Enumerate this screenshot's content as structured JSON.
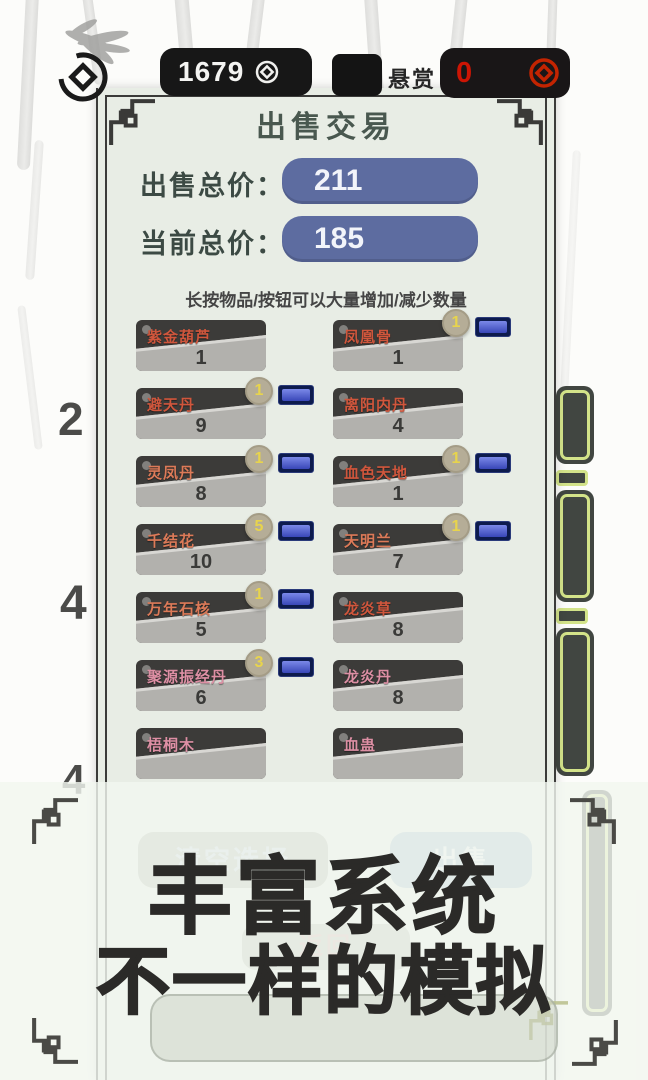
{
  "top_bar": {
    "coins": "1679",
    "bounty_label": "悬赏",
    "bounty_value": "0"
  },
  "dialog": {
    "title": "出售交易",
    "sell_total_label": "出售总价：",
    "sell_total_value": "211",
    "current_total_label": "当前总价：",
    "current_total_value": "185",
    "hint": "长按物品/按钮可以大量增加/减少数量",
    "items": [
      {
        "name": "紫金葫芦",
        "qty": "1",
        "badge": "",
        "color": "#d0563c"
      },
      {
        "name": "凤凰骨",
        "qty": "1",
        "badge": "1",
        "color": "#d0563c"
      },
      {
        "name": "避天丹",
        "qty": "9",
        "badge": "1",
        "color": "#d0563c"
      },
      {
        "name": "离阳内丹",
        "qty": "4",
        "badge": "",
        "color": "#d0563c"
      },
      {
        "name": "灵凤丹",
        "qty": "8",
        "badge": "1",
        "color": "#dc7a58"
      },
      {
        "name": "血色天地",
        "qty": "1",
        "badge": "1",
        "color": "#d0563c"
      },
      {
        "name": "千结花",
        "qty": "10",
        "badge": "5",
        "color": "#dc7a58"
      },
      {
        "name": "天明兰",
        "qty": "7",
        "badge": "1",
        "color": "#dc7a58"
      },
      {
        "name": "万年石核",
        "qty": "5",
        "badge": "1",
        "color": "#dc7a58"
      },
      {
        "name": "龙炎草",
        "qty": "8",
        "badge": "",
        "color": "#d0563c"
      },
      {
        "name": "聚源振经丹",
        "qty": "6",
        "badge": "3",
        "color": "#dd8fa4"
      },
      {
        "name": "龙炎丹",
        "qty": "8",
        "badge": "",
        "color": "#dd8fa4"
      },
      {
        "name": "梧桐木",
        "qty": "",
        "badge": "",
        "color": "#dd8fa4"
      },
      {
        "name": "血蛊",
        "qty": "",
        "badge": "",
        "color": "#dd8fa4"
      }
    ],
    "clear_button": "清空选择",
    "sell_button": "出售",
    "back_button": "返回"
  },
  "banner": {
    "line1": "丰富系统",
    "line2": "不一样的模拟"
  },
  "background": {
    "left_numbers": [
      "2",
      "4",
      "4"
    ]
  },
  "colors": {
    "dialog_bg": "#e8ede5",
    "price_pill": "#5d6ca0",
    "item_card_dark": "#3c3b39",
    "item_card_light": "#b2b1ad",
    "badge_bg": "#b5ad97",
    "badge_text": "#e8d44c",
    "blue_button": "#3947b8",
    "bounty_red": "#cc1504",
    "green_outline": "#d3e389"
  }
}
